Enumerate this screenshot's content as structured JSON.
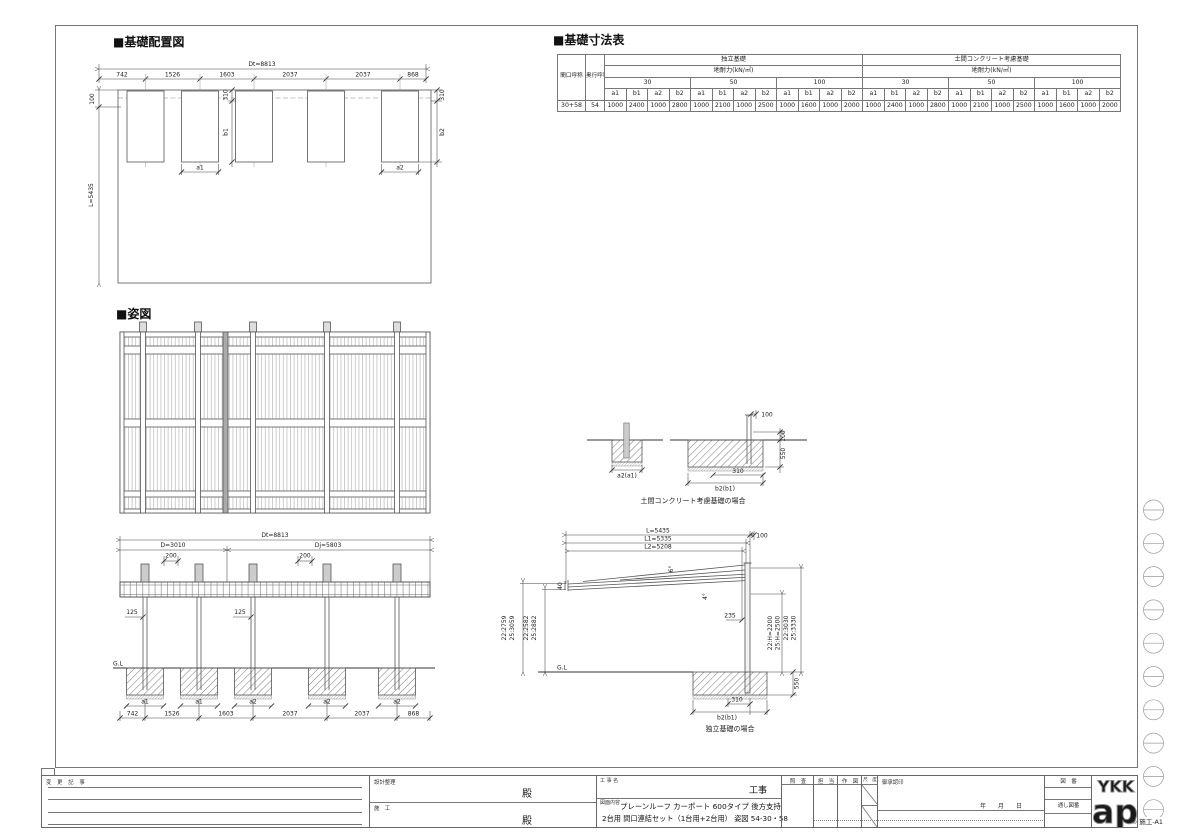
{
  "titles": {
    "plan": "■基礎配置図",
    "table": "■基礎寸法表",
    "front": "■姿図"
  },
  "dimtable": {
    "maguchi": "間口呼称",
    "okuyuki": "奥行呼称",
    "group1": "独立基礎",
    "group2": "土間コンクリート考慮基礎",
    "subhead": "地耐力(kN/㎡)",
    "loads": [
      "30",
      "50",
      "100"
    ],
    "cols": [
      "a1",
      "b1",
      "a2",
      "b2"
    ],
    "row": {
      "maguchi": "30+58",
      "okuyuki": "54",
      "v": [
        "1000",
        "2400",
        "1000",
        "2800",
        "1000",
        "2100",
        "1000",
        "2500",
        "1000",
        "1600",
        "1000",
        "2000",
        "1000",
        "2400",
        "1000",
        "2800",
        "1000",
        "2100",
        "1000",
        "2500",
        "1000",
        "1600",
        "1000",
        "2000"
      ]
    }
  },
  "plan": {
    "dt": "Dt=8813",
    "seg": [
      "742",
      "1526",
      "1603",
      "2037",
      "2037",
      "868"
    ],
    "d100": "100",
    "l": "L=5435",
    "d310l": "310",
    "b1": "b1",
    "a1": "a1",
    "d310r": "310",
    "b2": "b2",
    "a2": "a2"
  },
  "front": {
    "dt": "Dt=8813",
    "d": "D=3010",
    "dj": "Dj=5803",
    "off1": "200",
    "off2": "200",
    "p1": "125",
    "p2": "125",
    "gl": "G.L",
    "foot": [
      "a1",
      "a1",
      "a2",
      "a2",
      "a2"
    ],
    "seg": [
      "742",
      "1526",
      "1603",
      "2037",
      "2037",
      "868"
    ]
  },
  "doma": {
    "a": "a2(a1)",
    "b": "b2(b1)",
    "d310": "310",
    "t100": "100",
    "r100": "100",
    "d550": "550",
    "caption": "土間コンクリート考慮基礎の場合"
  },
  "side": {
    "l": "L=5435",
    "l1": "L1=5335",
    "l2": "L2=5208",
    "d100": "100",
    "d40": "40",
    "a6": "6°",
    "a4": "4°",
    "d235": "235",
    "lo": [
      "22:2759",
      "25:3059"
    ],
    "li": [
      "22:2582",
      "25:2882"
    ],
    "ri": [
      "22:H=2200",
      "25:H=2500"
    ],
    "ro": [
      "22:3030",
      "25:3330"
    ],
    "gl": "G.L",
    "d550": "550",
    "d310": "310",
    "b": "b2(b1)",
    "caption": "独立基礎の場合"
  },
  "tb": {
    "henkou": "変 更 記 事",
    "sekkei": "設計整理",
    "dono1": "殿",
    "sekou": "施　工",
    "dono2": "殿",
    "koujimei": "工 事 名",
    "kouji": "工事",
    "naiyou": "図面内容",
    "line1": "プレーンルーフ カーポート 600タイプ 後方支持",
    "line2": "2台用 間口連結セット（1台用+2台用） 姿図 54-30・58",
    "c1": "照　査",
    "c2": "担　当",
    "c3": "作　図",
    "c4": "尺　度",
    "approval": "御承認印",
    "ymd": "年　　月　　日",
    "zuban": "図　番",
    "tooshi": "通し図番",
    "logo1": "YKK",
    "logo2": "ap",
    "stamp": "® 施工-A1"
  }
}
